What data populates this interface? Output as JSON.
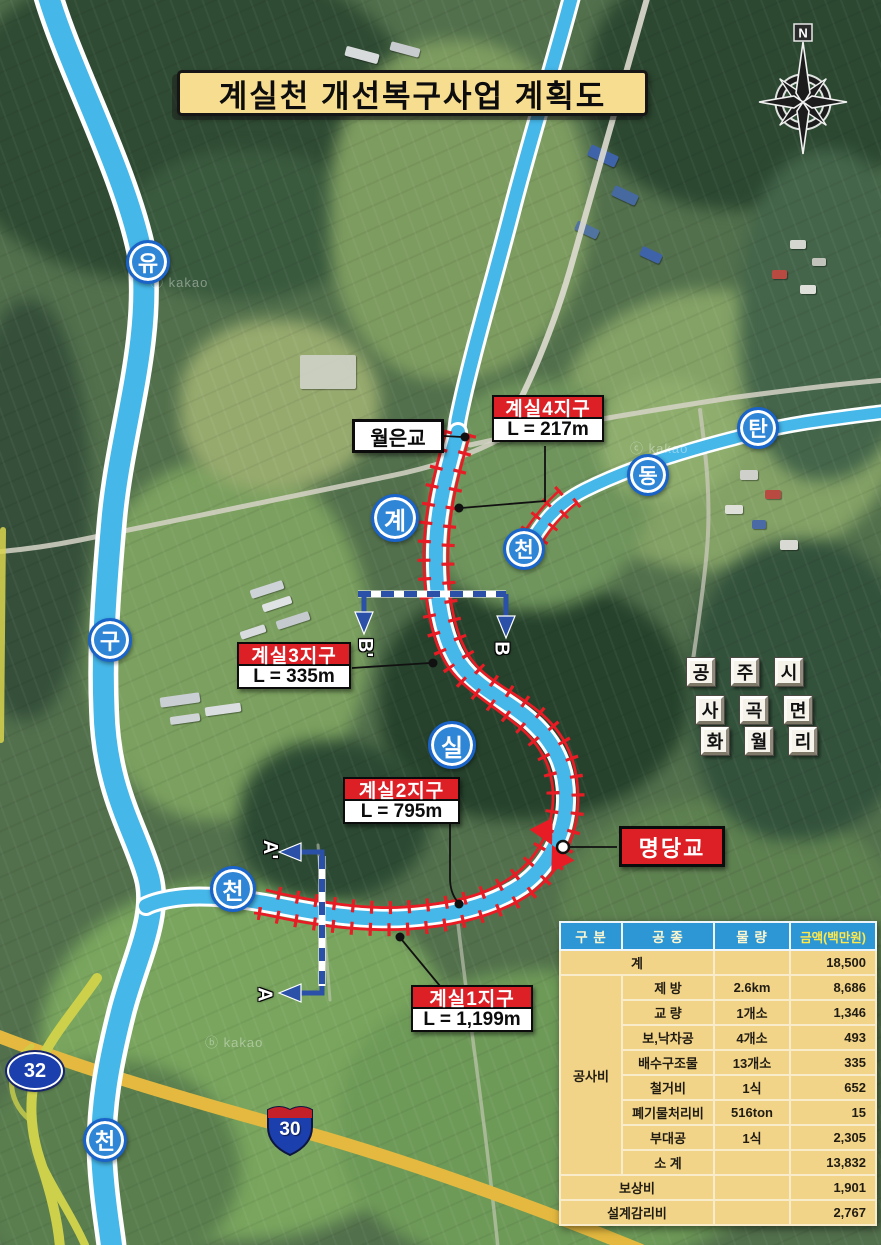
{
  "title": "계실천 개선복구사업 계획도",
  "compass": {
    "north": "N"
  },
  "watermarks": {
    "w1": "ⓑ kakao",
    "w2": "ⓒ kakao",
    "w3": "ⓑ kakao"
  },
  "river_markers": [
    {
      "id": "yugu-1",
      "char": "유"
    },
    {
      "id": "yugu-2",
      "char": "구"
    },
    {
      "id": "yugu-3",
      "char": "천"
    },
    {
      "id": "gyesil-1",
      "char": "계"
    },
    {
      "id": "gyesil-2",
      "char": "실"
    },
    {
      "id": "gyesil-3",
      "char": "천"
    },
    {
      "id": "tandong-1",
      "char": "탄"
    },
    {
      "id": "tandong-2",
      "char": "동"
    },
    {
      "id": "tandong-3",
      "char": "천"
    }
  ],
  "districts": [
    {
      "name": "계실4지구",
      "length": "L = 217m"
    },
    {
      "name": "계실3지구",
      "length": "L = 335m"
    },
    {
      "name": "계실2지구",
      "length": "L = 795m"
    },
    {
      "name": "계실1지구",
      "length": "L = 1,199m"
    }
  ],
  "bridges": {
    "woleun": "월은교",
    "myeongdang": "명당교"
  },
  "admin_area": {
    "rows": [
      [
        "공",
        "주",
        "시"
      ],
      [
        "사",
        "곡",
        "면"
      ],
      [
        "화",
        "월",
        "리"
      ]
    ]
  },
  "road_signs": {
    "route32": "32",
    "route30": "30"
  },
  "sections": {
    "b_prime": "B'",
    "b": "B",
    "a_prime": "A'",
    "a": "A"
  },
  "cost_table": {
    "headers": [
      "구 분",
      "공 종",
      "물 량",
      "금액(백만원)"
    ],
    "total": {
      "label": "계",
      "qty": "",
      "amount": "18,500"
    },
    "construction": {
      "label": "공사비",
      "items": [
        {
          "work": "제 방",
          "qty": "2.6km",
          "amount": "8,686"
        },
        {
          "work": "교 량",
          "qty": "1개소",
          "amount": "1,346"
        },
        {
          "work": "보,낙차공",
          "qty": "4개소",
          "amount": "493"
        },
        {
          "work": "배수구조물",
          "qty": "13개소",
          "amount": "335"
        },
        {
          "work": "철거비",
          "qty": "1식",
          "amount": "652"
        },
        {
          "work": "폐기물처리비",
          "qty": "516ton",
          "amount": "15"
        },
        {
          "work": "부대공",
          "qty": "1식",
          "amount": "2,305"
        },
        {
          "work": "소 계",
          "qty": "",
          "amount": "13,832"
        }
      ]
    },
    "footer_rows": [
      {
        "label": "보상비",
        "amount": "1,901"
      },
      {
        "label": "설계감리비",
        "amount": "2,767"
      }
    ]
  },
  "colors": {
    "banner_bg": "#f6dd90",
    "river_blue": "#45b7e8",
    "levee_red": "#e81c24",
    "section_blue": "#2b50a8",
    "district_red": "#dd1f26",
    "marker_blue": "#2f86d6",
    "table_header_bg": "#2d96d4",
    "table_body_bg": "#f2d488",
    "money_header_text": "#ffe84a"
  }
}
